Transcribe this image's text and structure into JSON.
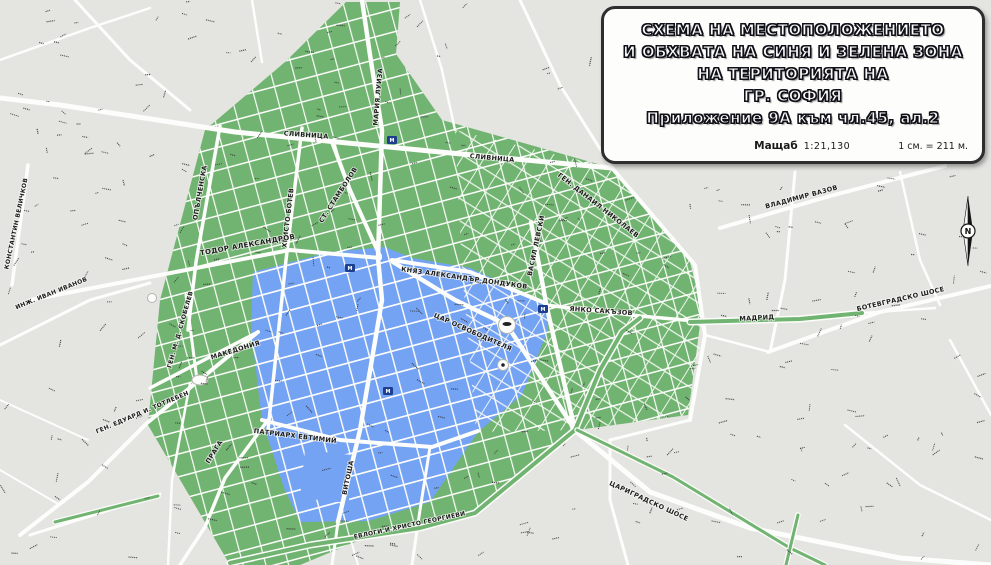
{
  "title_box": {
    "line1": "СХЕМА НА МЕСТОПОЛОЖЕНИЕТО",
    "line2": "И ОБХВАТА НА СИНЯ И ЗЕЛЕНА ЗОНА",
    "line3": "НА ТЕРИТОРИЯТА НА",
    "line4": "ГР. СОФИЯ",
    "line5": "Приложение 9А към чл.45, ал.2",
    "scale_label": "Мащаб",
    "scale_ratio": "1:21,130",
    "scale_equiv": "1 см. = 211 м."
  },
  "colors": {
    "background": "#e4e4e1",
    "road": "#fdfdfb",
    "green_zone": "#71b471",
    "blue_zone": "#74a3f3",
    "street_label": "#1c1c1c",
    "metro_badge": "#1d3e8f"
  },
  "compass": {
    "label": "N"
  },
  "metro_badges": {
    "label": "М",
    "positions": [
      {
        "x": 350,
        "y": 268
      },
      {
        "x": 543,
        "y": 309
      },
      {
        "x": 388,
        "y": 391
      },
      {
        "x": 392,
        "y": 140
      }
    ]
  },
  "streets": [
    {
      "name": "СЛИВНИЦА",
      "x": 306,
      "y": 137,
      "rot": 4,
      "size": 6.5
    },
    {
      "name": "СЛИВНИЦА",
      "x": 492,
      "y": 160,
      "rot": 5,
      "size": 6.5
    },
    {
      "name": "ОПЪЛЧЕНСКА",
      "x": 202,
      "y": 193,
      "rot": -80,
      "size": 6.5
    },
    {
      "name": "ХРИСТО БОТЕВ",
      "x": 290,
      "y": 218,
      "rot": -83,
      "size": 6.5
    },
    {
      "name": "МАРИЯ ЛУИЗА",
      "x": 380,
      "y": 97,
      "rot": -85,
      "size": 6.5
    },
    {
      "name": "СТ. СТАМБОЛОВ",
      "x": 340,
      "y": 196,
      "rot": -57,
      "size": 6.5
    },
    {
      "name": "ТОДОР АЛЕКСАНДРОВ",
      "x": 248,
      "y": 247,
      "rot": -10,
      "size": 7
    },
    {
      "name": "КНЯЗ АЛЕКСАНДЪР ДОНДУКОВ",
      "x": 464,
      "y": 280,
      "rot": 8,
      "size": 6.5
    },
    {
      "name": "ГЕН. ДАНАИЛ НИКОЛАЕВ",
      "x": 597,
      "y": 207,
      "rot": 38,
      "size": 6.5
    },
    {
      "name": "ВАСИЛ ЛЕВСКИ",
      "x": 538,
      "y": 246,
      "rot": -78,
      "size": 6.5
    },
    {
      "name": "ЯНКО САКЪЗОВ",
      "x": 601,
      "y": 313,
      "rot": 4,
      "size": 6.5
    },
    {
      "name": "МАДРИД",
      "x": 757,
      "y": 320,
      "rot": -3,
      "size": 6.5
    },
    {
      "name": "ЦАР ОСВОБОДИТЕЛЯ",
      "x": 472,
      "y": 334,
      "rot": 24,
      "size": 6.5
    },
    {
      "name": "ПАТРИАРХ ЕВТИМИЙ",
      "x": 295,
      "y": 438,
      "rot": 7,
      "size": 6.5
    },
    {
      "name": "ВИТОША",
      "x": 350,
      "y": 478,
      "rot": -78,
      "size": 6.5
    },
    {
      "name": "ПРАГА",
      "x": 216,
      "y": 453,
      "rot": -58,
      "size": 6.5
    },
    {
      "name": "МАКЕДОНИЯ",
      "x": 236,
      "y": 352,
      "rot": -17,
      "size": 6.5
    },
    {
      "name": "ГЕН. М. Д. СКОБЕЛЕВ",
      "x": 182,
      "y": 330,
      "rot": -74,
      "size": 6
    },
    {
      "name": "ГЕН. ЕДУАРД И. ТОТЛЕБЕН",
      "x": 143,
      "y": 414,
      "rot": -23,
      "size": 6
    },
    {
      "name": "КОНСТАНТИН ВЕЛИЧКОВ",
      "x": 18,
      "y": 224,
      "rot": -78,
      "size": 6
    },
    {
      "name": "ИНЖ. ИВАН ИВАНОВ",
      "x": 52,
      "y": 295,
      "rot": -22,
      "size": 6
    },
    {
      "name": "ЕВЛОГИ И ХРИСТО ГЕОРГИЕВИ",
      "x": 410,
      "y": 527,
      "rot": -12,
      "size": 6
    },
    {
      "name": "ЦАРИГРАДСКО ШОСЕ",
      "x": 648,
      "y": 503,
      "rot": 25,
      "size": 6.5
    },
    {
      "name": "ВЛАДИМИР ВАЗОВ",
      "x": 802,
      "y": 199,
      "rot": -15,
      "size": 6.5
    },
    {
      "name": "БОТЕВГРАДСКО ШОСЕ",
      "x": 901,
      "y": 301,
      "rot": -13,
      "size": 6.5
    }
  ]
}
